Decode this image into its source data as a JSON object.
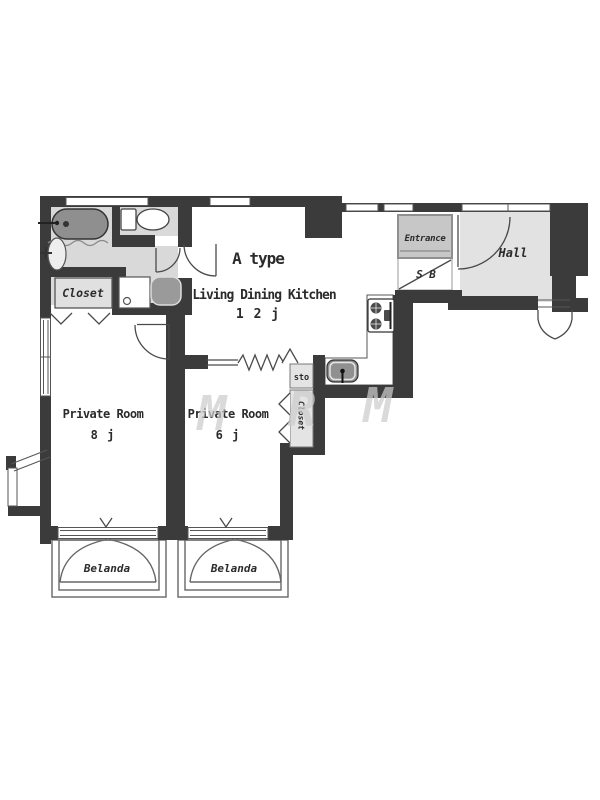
{
  "floor_plan": {
    "unit_type": "A type",
    "ldk_label": "Living Dining Kitchen",
    "ldk_size": "1 2 j",
    "room1_label": "Private Room",
    "room1_size": "8 j",
    "room2_label": "Private Room",
    "room2_size": "6 j",
    "closet_label": "Closet",
    "closet2_label": "Closet",
    "sto_label": "sto",
    "entrance_label": "Entrance",
    "shoe_box_label": "S B",
    "hall_label": "Hall",
    "balcony1_label": "Belanda",
    "balcony2_label": "Belanda",
    "watermark_letters": [
      "M",
      "R",
      "M"
    ],
    "colors": {
      "wall": "#3b3b3b",
      "room_gray": "#d9d9d9",
      "entrance_gray": "#c7c7c7",
      "hall_gray": "#e2e2e2",
      "fixture_gray": "#949494",
      "line": "#555555"
    }
  }
}
